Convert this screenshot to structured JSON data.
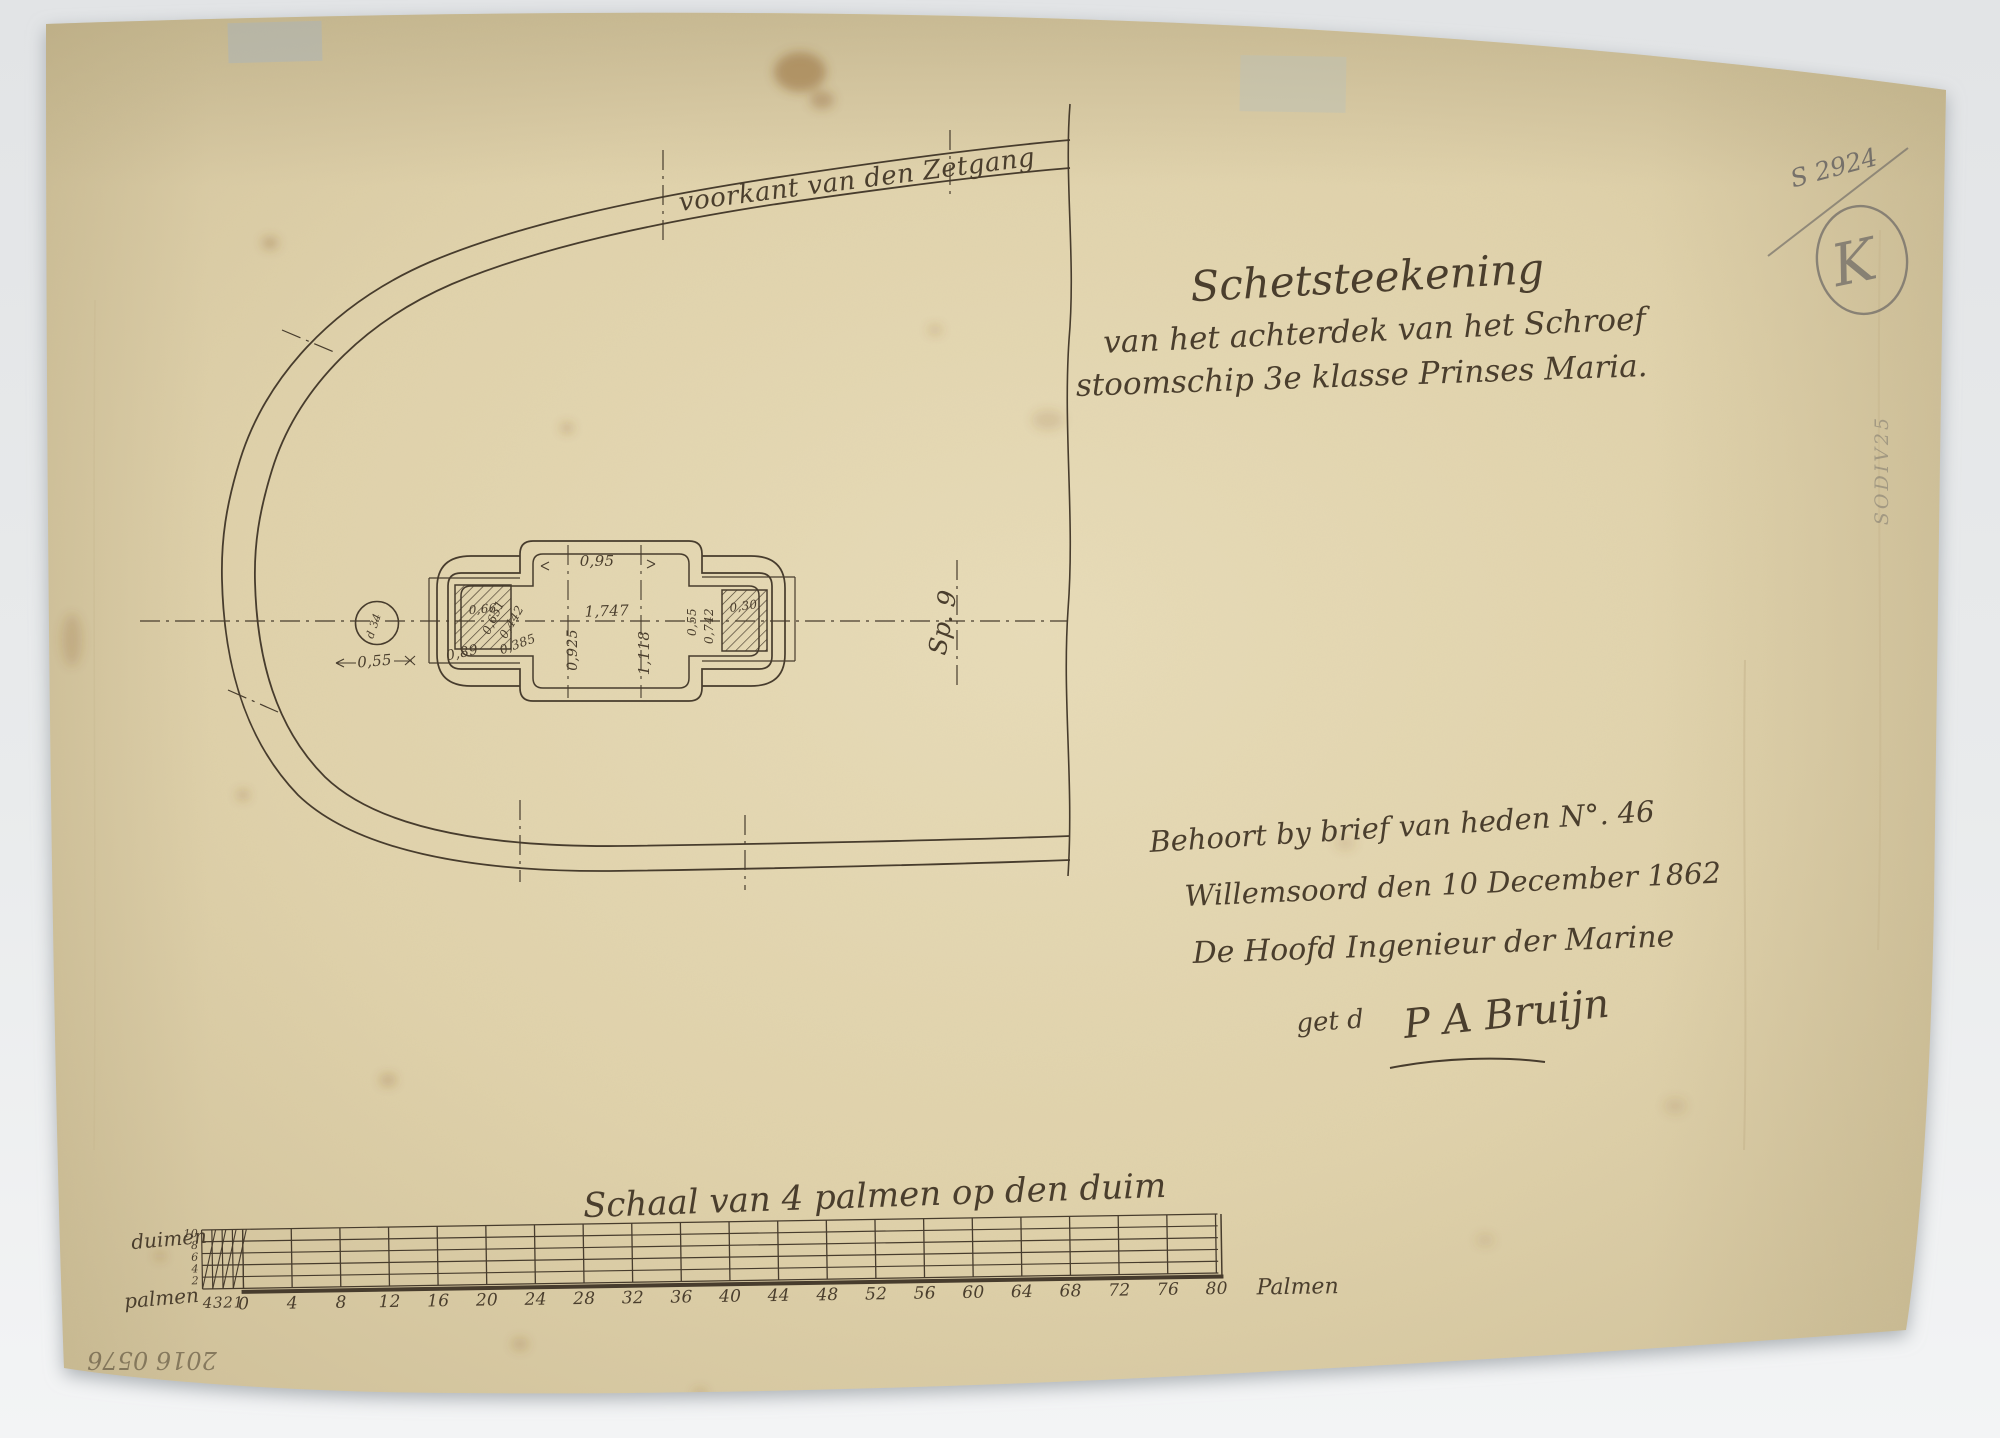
{
  "drawing": {
    "curve_label": "voorkant van den Zetgang",
    "frame_label": "Sp. 9",
    "dims": {
      "top_width": "0,95",
      "mid_width": "1,747",
      "height_left": "0,925",
      "height_right": "1,118",
      "left_outer": "0,89",
      "diag_a": "0,651",
      "diag_b": "0,442",
      "diag_c": "0,385",
      "left_block": "0,66",
      "right_block": "0,30",
      "right_gap": "0,55",
      "right_width": "0,742",
      "shaft_offset": "0,55",
      "shaft_diameter": "d 34"
    }
  },
  "title_block": {
    "line1": "Schetsteekening",
    "line2": "van het achterdek van het Schroef",
    "line3": "stoomschip 3e klasse Prinses Maria."
  },
  "letter_block": {
    "line1": "Behoort by brief van heden N°. 46",
    "line2": "Willemsoord den 10 December 1862",
    "line3": "De Hoofd Ingenieur der Marine",
    "signature_prefix": "get d",
    "signature": "P A Bruijn"
  },
  "annotations": {
    "archive_number": "S 2924",
    "stamp_letter": "K",
    "edge_inscription": "SODIV25",
    "inventory_number": "2016 0576"
  },
  "scale_bar": {
    "title": "Schaal van 4 palmen op den duim",
    "unit_left_top": "duimen",
    "unit_left_bottom": "palmen",
    "unit_right": "Palmen",
    "duim_ticks": [
      "10",
      "8",
      "6",
      "4",
      "2"
    ],
    "pre_ticks": [
      "4",
      "3",
      "2",
      "1"
    ],
    "main_ticks": [
      "0",
      "4",
      "8",
      "12",
      "16",
      "20",
      "24",
      "28",
      "32",
      "36",
      "40",
      "44",
      "48",
      "52",
      "56",
      "60",
      "64",
      "68",
      "72",
      "76",
      "80"
    ]
  },
  "colors": {
    "paper": "#decfa9",
    "ink": "#473c2d",
    "pencil": "#76716a",
    "backdrop": "#e9ebec"
  }
}
